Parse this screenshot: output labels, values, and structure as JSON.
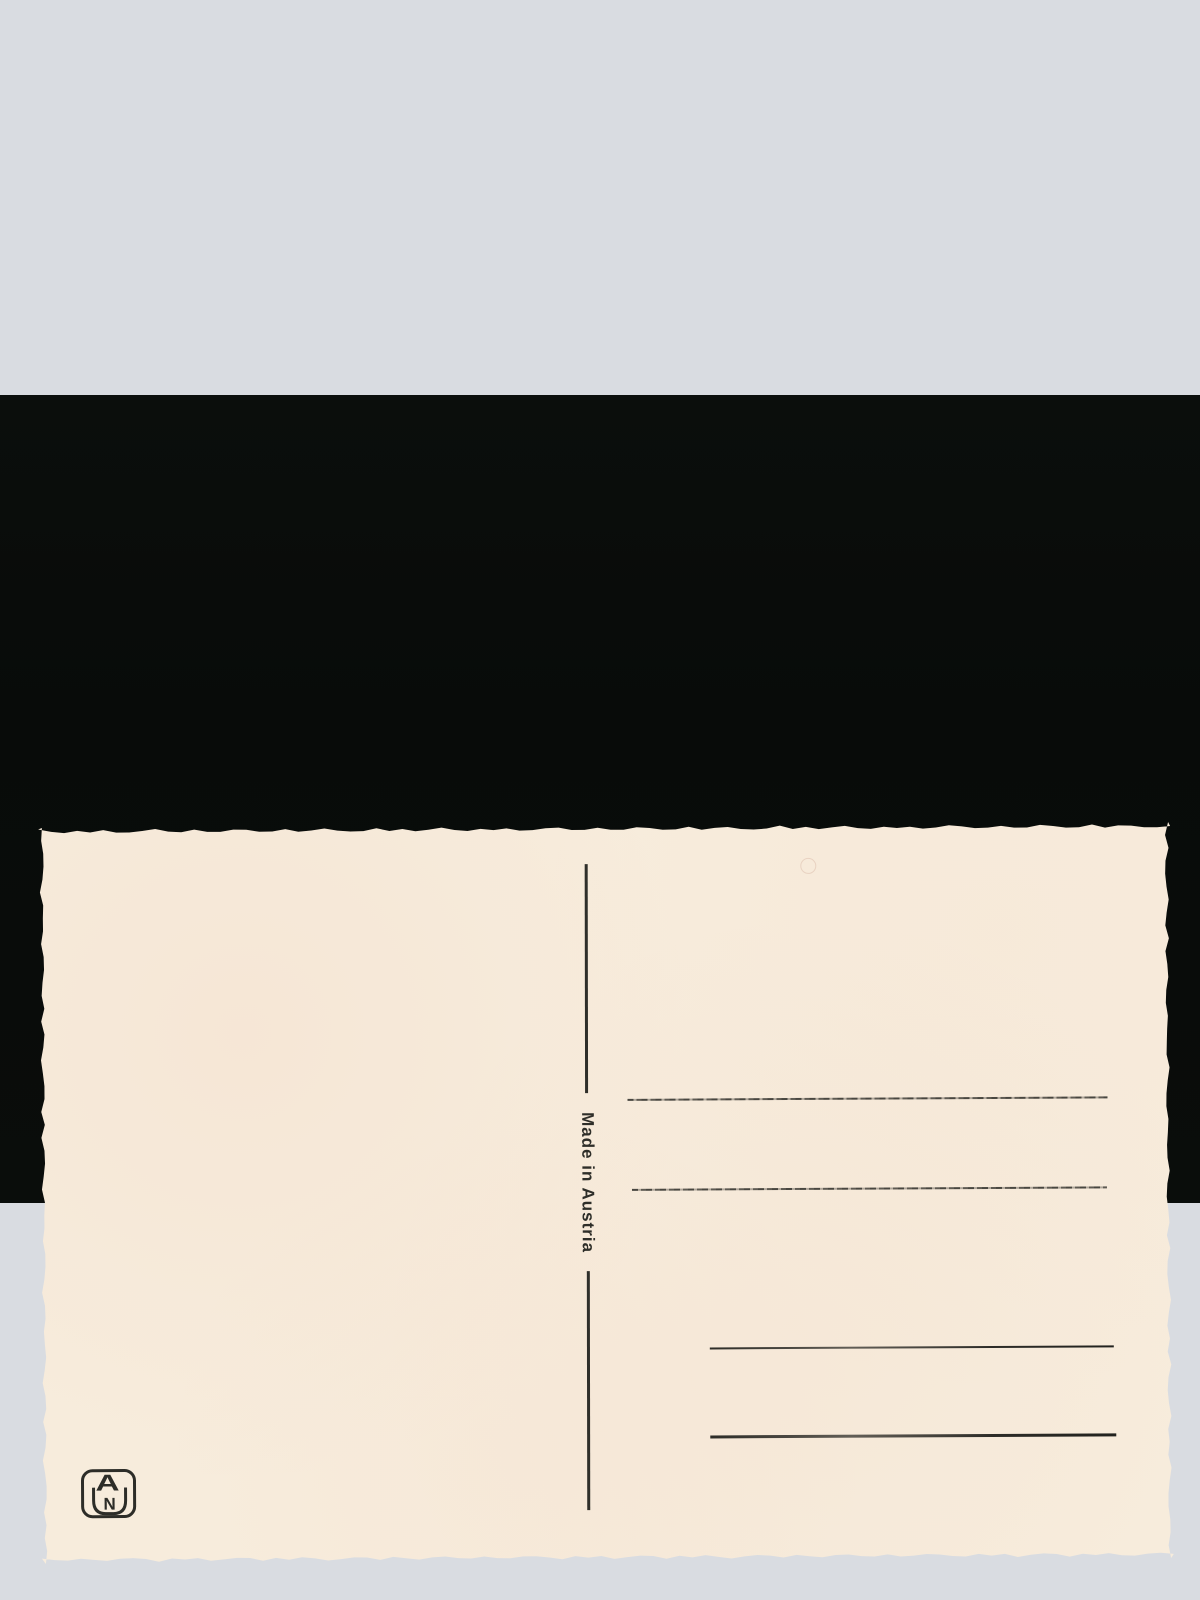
{
  "photo": {
    "background_color": "#d9dce1",
    "mat_color": "#0a0d0b"
  },
  "postcard": {
    "paper_color": "#f7ecdc",
    "ink_color": "#2e2e29",
    "made_in_label": "Made in Austria",
    "writing_lines_count": 4,
    "publisher_monogram": {
      "apex_letter": "A",
      "inner_letter": "N"
    }
  }
}
